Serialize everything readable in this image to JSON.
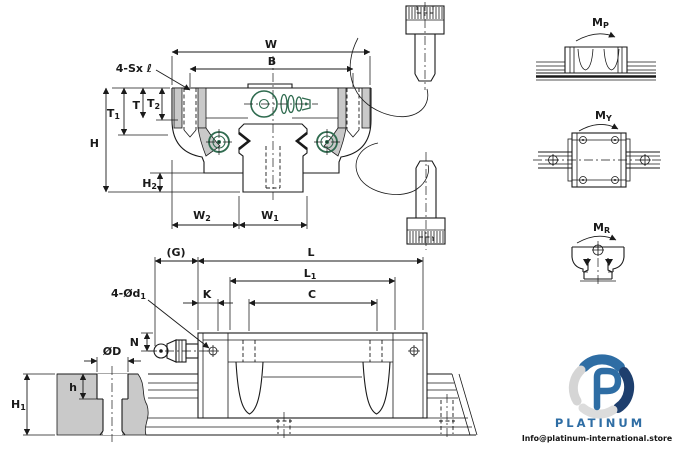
{
  "colors": {
    "line": "#1a1a1a",
    "section_gray": "#c9c9c9",
    "grease_green": "#2f6b4f",
    "brand_blue": "#2e6da4",
    "brand_navy": "#1e3f6e",
    "brand_gray": "#d5d5d5"
  },
  "cross_section_view": {
    "labels": {
      "w": "W",
      "b": "B",
      "screw_note_prefix": "4-Sx ",
      "screw_note_symbol": "ℓ",
      "t1_main": "T",
      "t1_sub": "1",
      "t_main": "T",
      "t2_main": "T",
      "t2_sub": "2",
      "h": "H",
      "h2_main": "H",
      "h2_sub": "2",
      "w2_main": "W",
      "w2_sub": "2",
      "w1_main": "W",
      "w1_sub": "1"
    }
  },
  "moment_diagrams": {
    "pitch_main": "M",
    "pitch_sub": "P",
    "yaw_main": "M",
    "yaw_sub": "Y",
    "roll_main": "M",
    "roll_sub": "R"
  },
  "side_view": {
    "labels": {
      "g": "(G)",
      "l": "L",
      "l1_main": "L",
      "l1_sub": "1",
      "k": "K",
      "c": "C",
      "hole_note_main": "4-Ød",
      "hole_note_sub": "1",
      "n": "N",
      "d": "ØD",
      "h_depth": "h",
      "h1_main": "H",
      "h1_sub": "1"
    }
  },
  "watermark": {
    "brand": "PLATINUM",
    "email": "Info@platinum-international.store"
  }
}
